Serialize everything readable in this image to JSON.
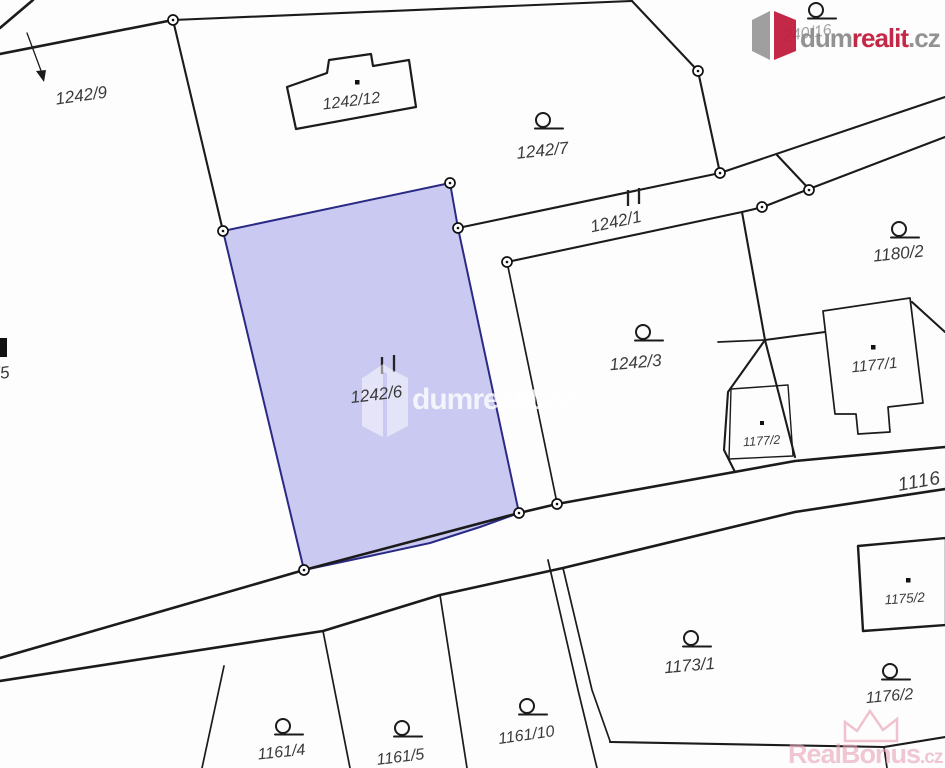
{
  "map": {
    "labels": {
      "p1242_9": "1242/9",
      "p1242_12": "1242/12",
      "p1242_7": "1242/7",
      "p1242_1": "1242/1",
      "p1242_6": "1242/6",
      "p1242_3": "1242/3",
      "p1180_2": "1180/2",
      "p1177_1": "1177/1",
      "p1177_2": "1177/2",
      "p1175_2": "1175/2",
      "p1173_1": "1173/1",
      "p1176_2": "1176/2",
      "p1161_4": "1161/4",
      "p1161_5": "1161/5",
      "p1161_10": "1161/10",
      "p1116": "1116",
      "p240_16": "240/16",
      "p_5": "/5"
    },
    "highlight": {
      "parcel": "1242/6",
      "fill": "#cac9f1",
      "border": "#2a2a85"
    },
    "line_color": "#1b1b1b"
  },
  "brand": {
    "logo": {
      "part1": "dum",
      "part2": "realit",
      "part3": ".cz",
      "gray": "#8d8d8d",
      "red": "#c21d3e"
    },
    "center_watermark": "dumrealit.cz",
    "bottom_watermark": {
      "text": "RealBonus",
      "suffix": ".cz",
      "color": "#e7a2b5"
    }
  }
}
